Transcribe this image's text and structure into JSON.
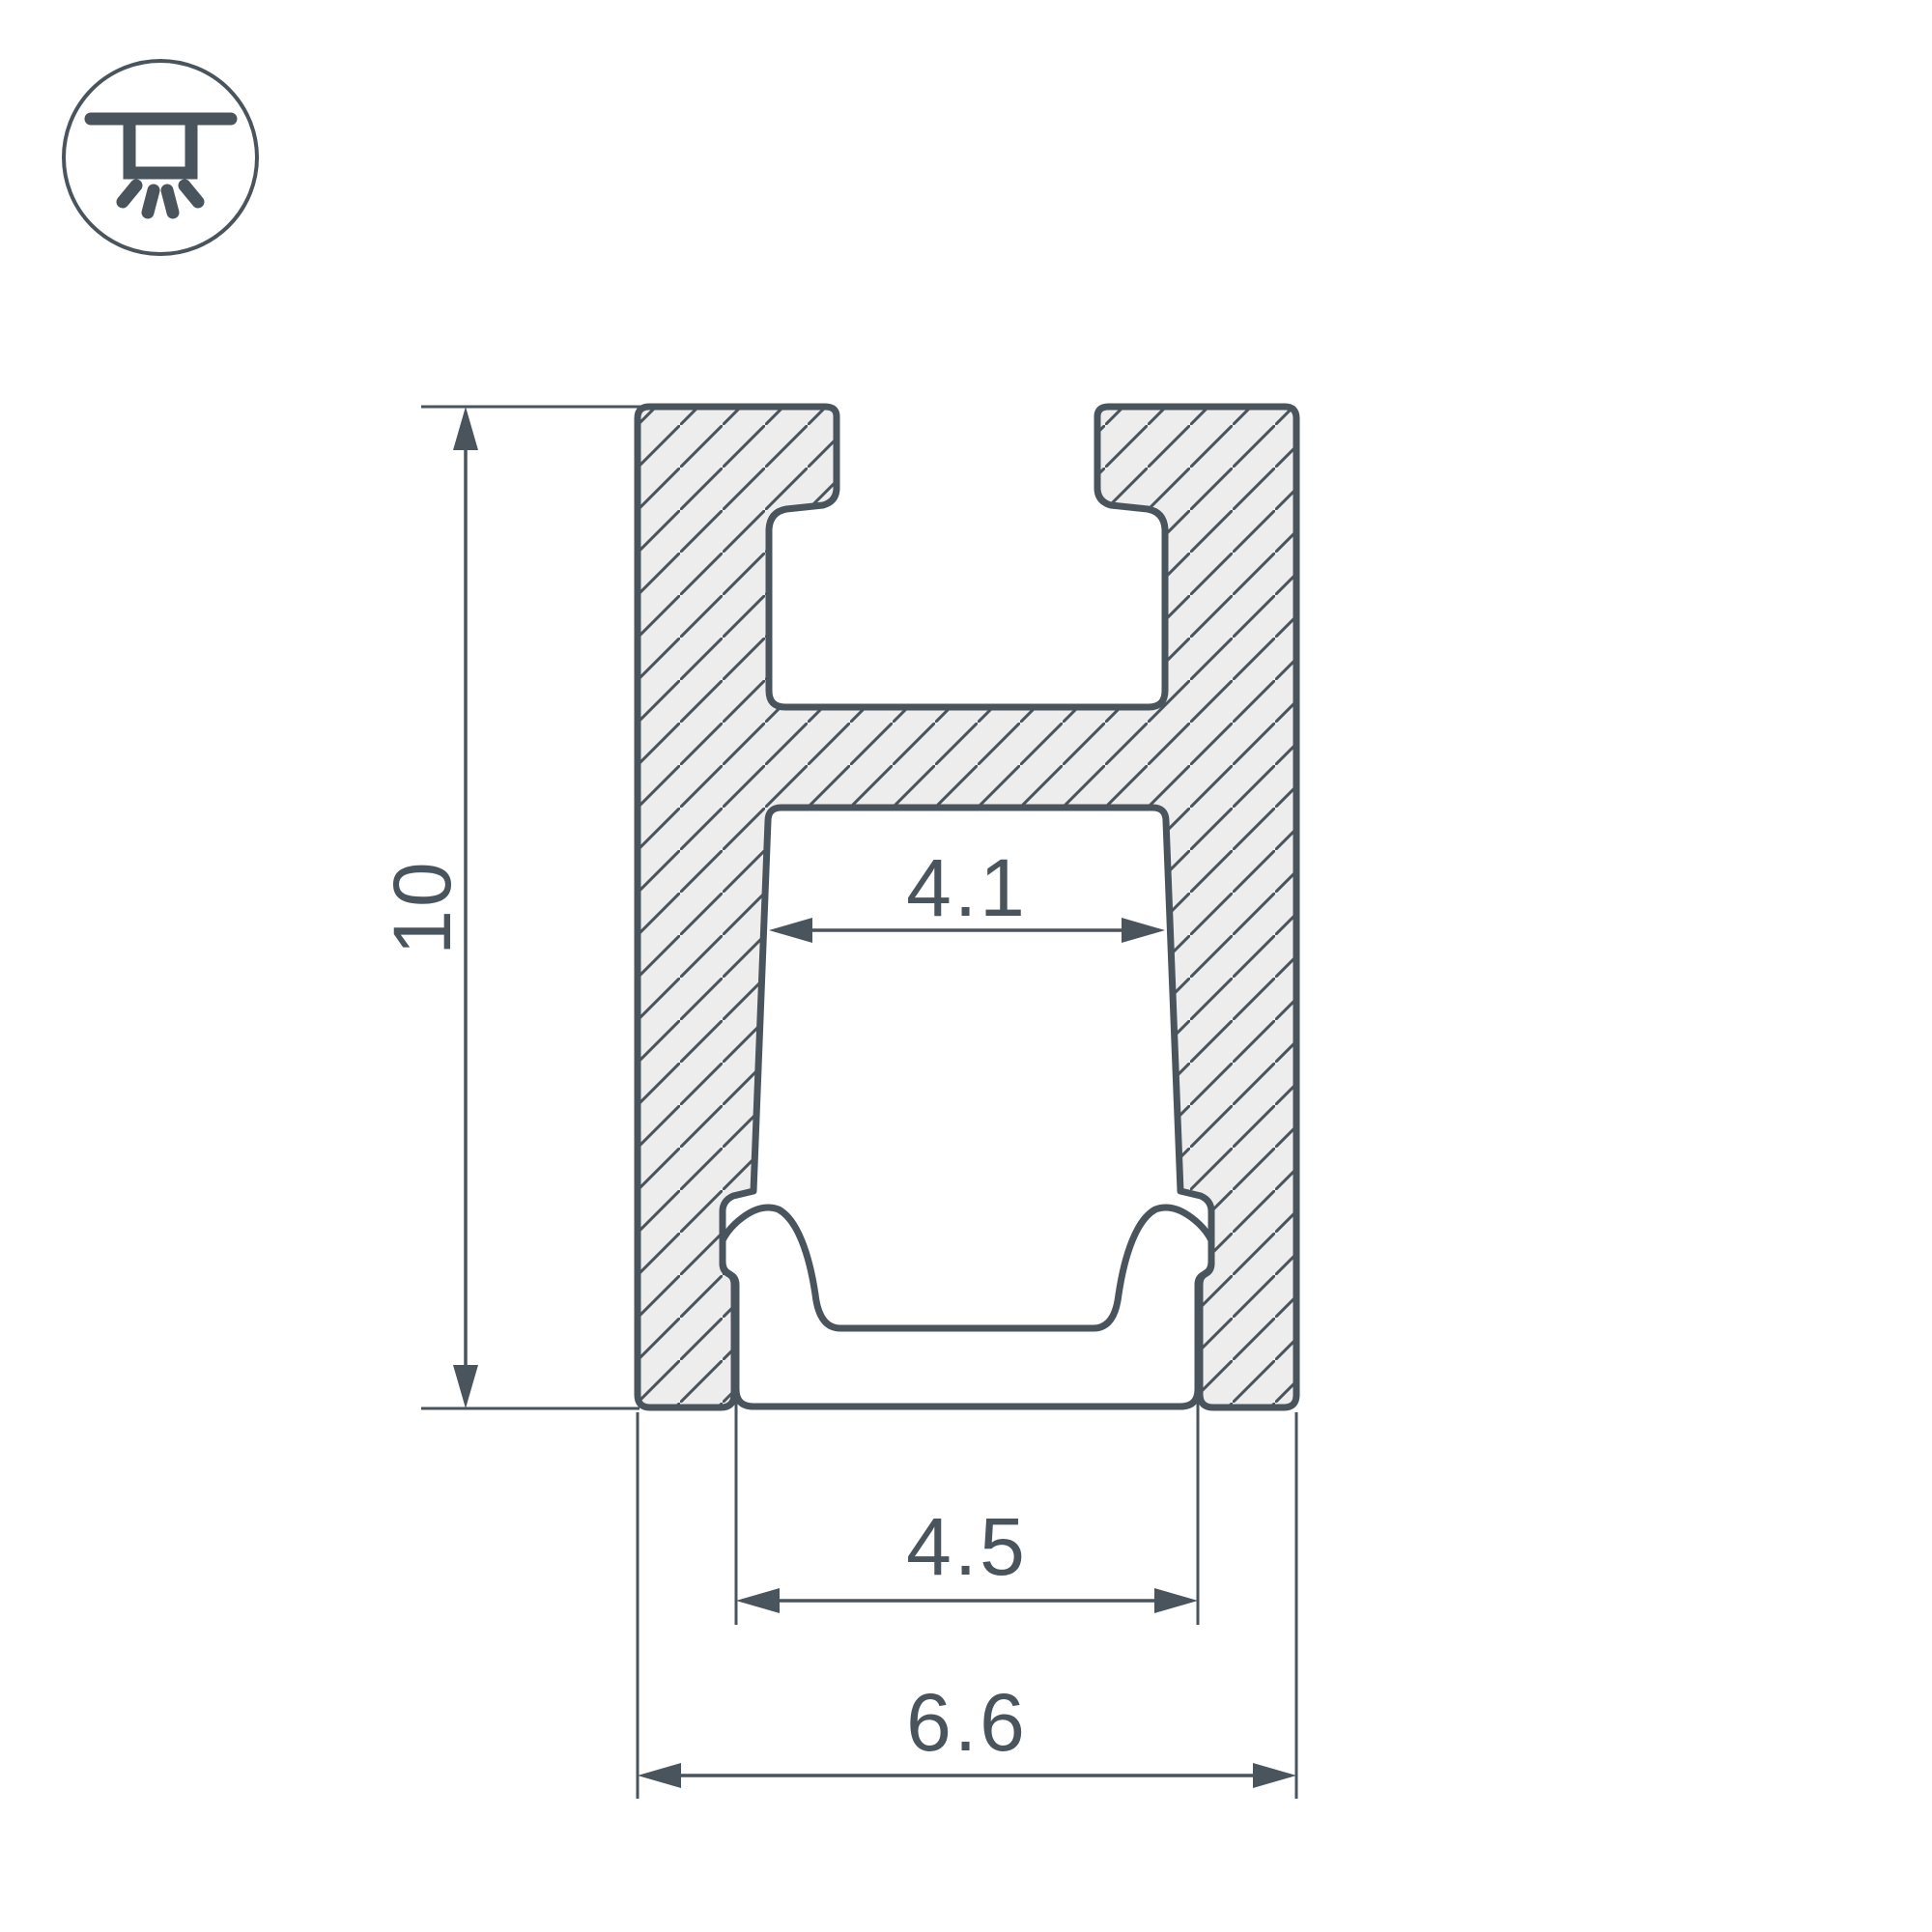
{
  "drawing": {
    "kind": "led-profile-cross-section",
    "background": "#ffffff"
  },
  "colors": {
    "line": "#4A545D",
    "hatch_fill": "#EDEDEE",
    "part_fill": "#FFFFFF"
  },
  "icon": {
    "name": "recessed-ceiling-light-icon"
  },
  "dimensions": {
    "overall_height": "10",
    "inner_cavity_width": "4.1",
    "bottom_opening_width": "4.5",
    "overall_width": "6.6"
  }
}
